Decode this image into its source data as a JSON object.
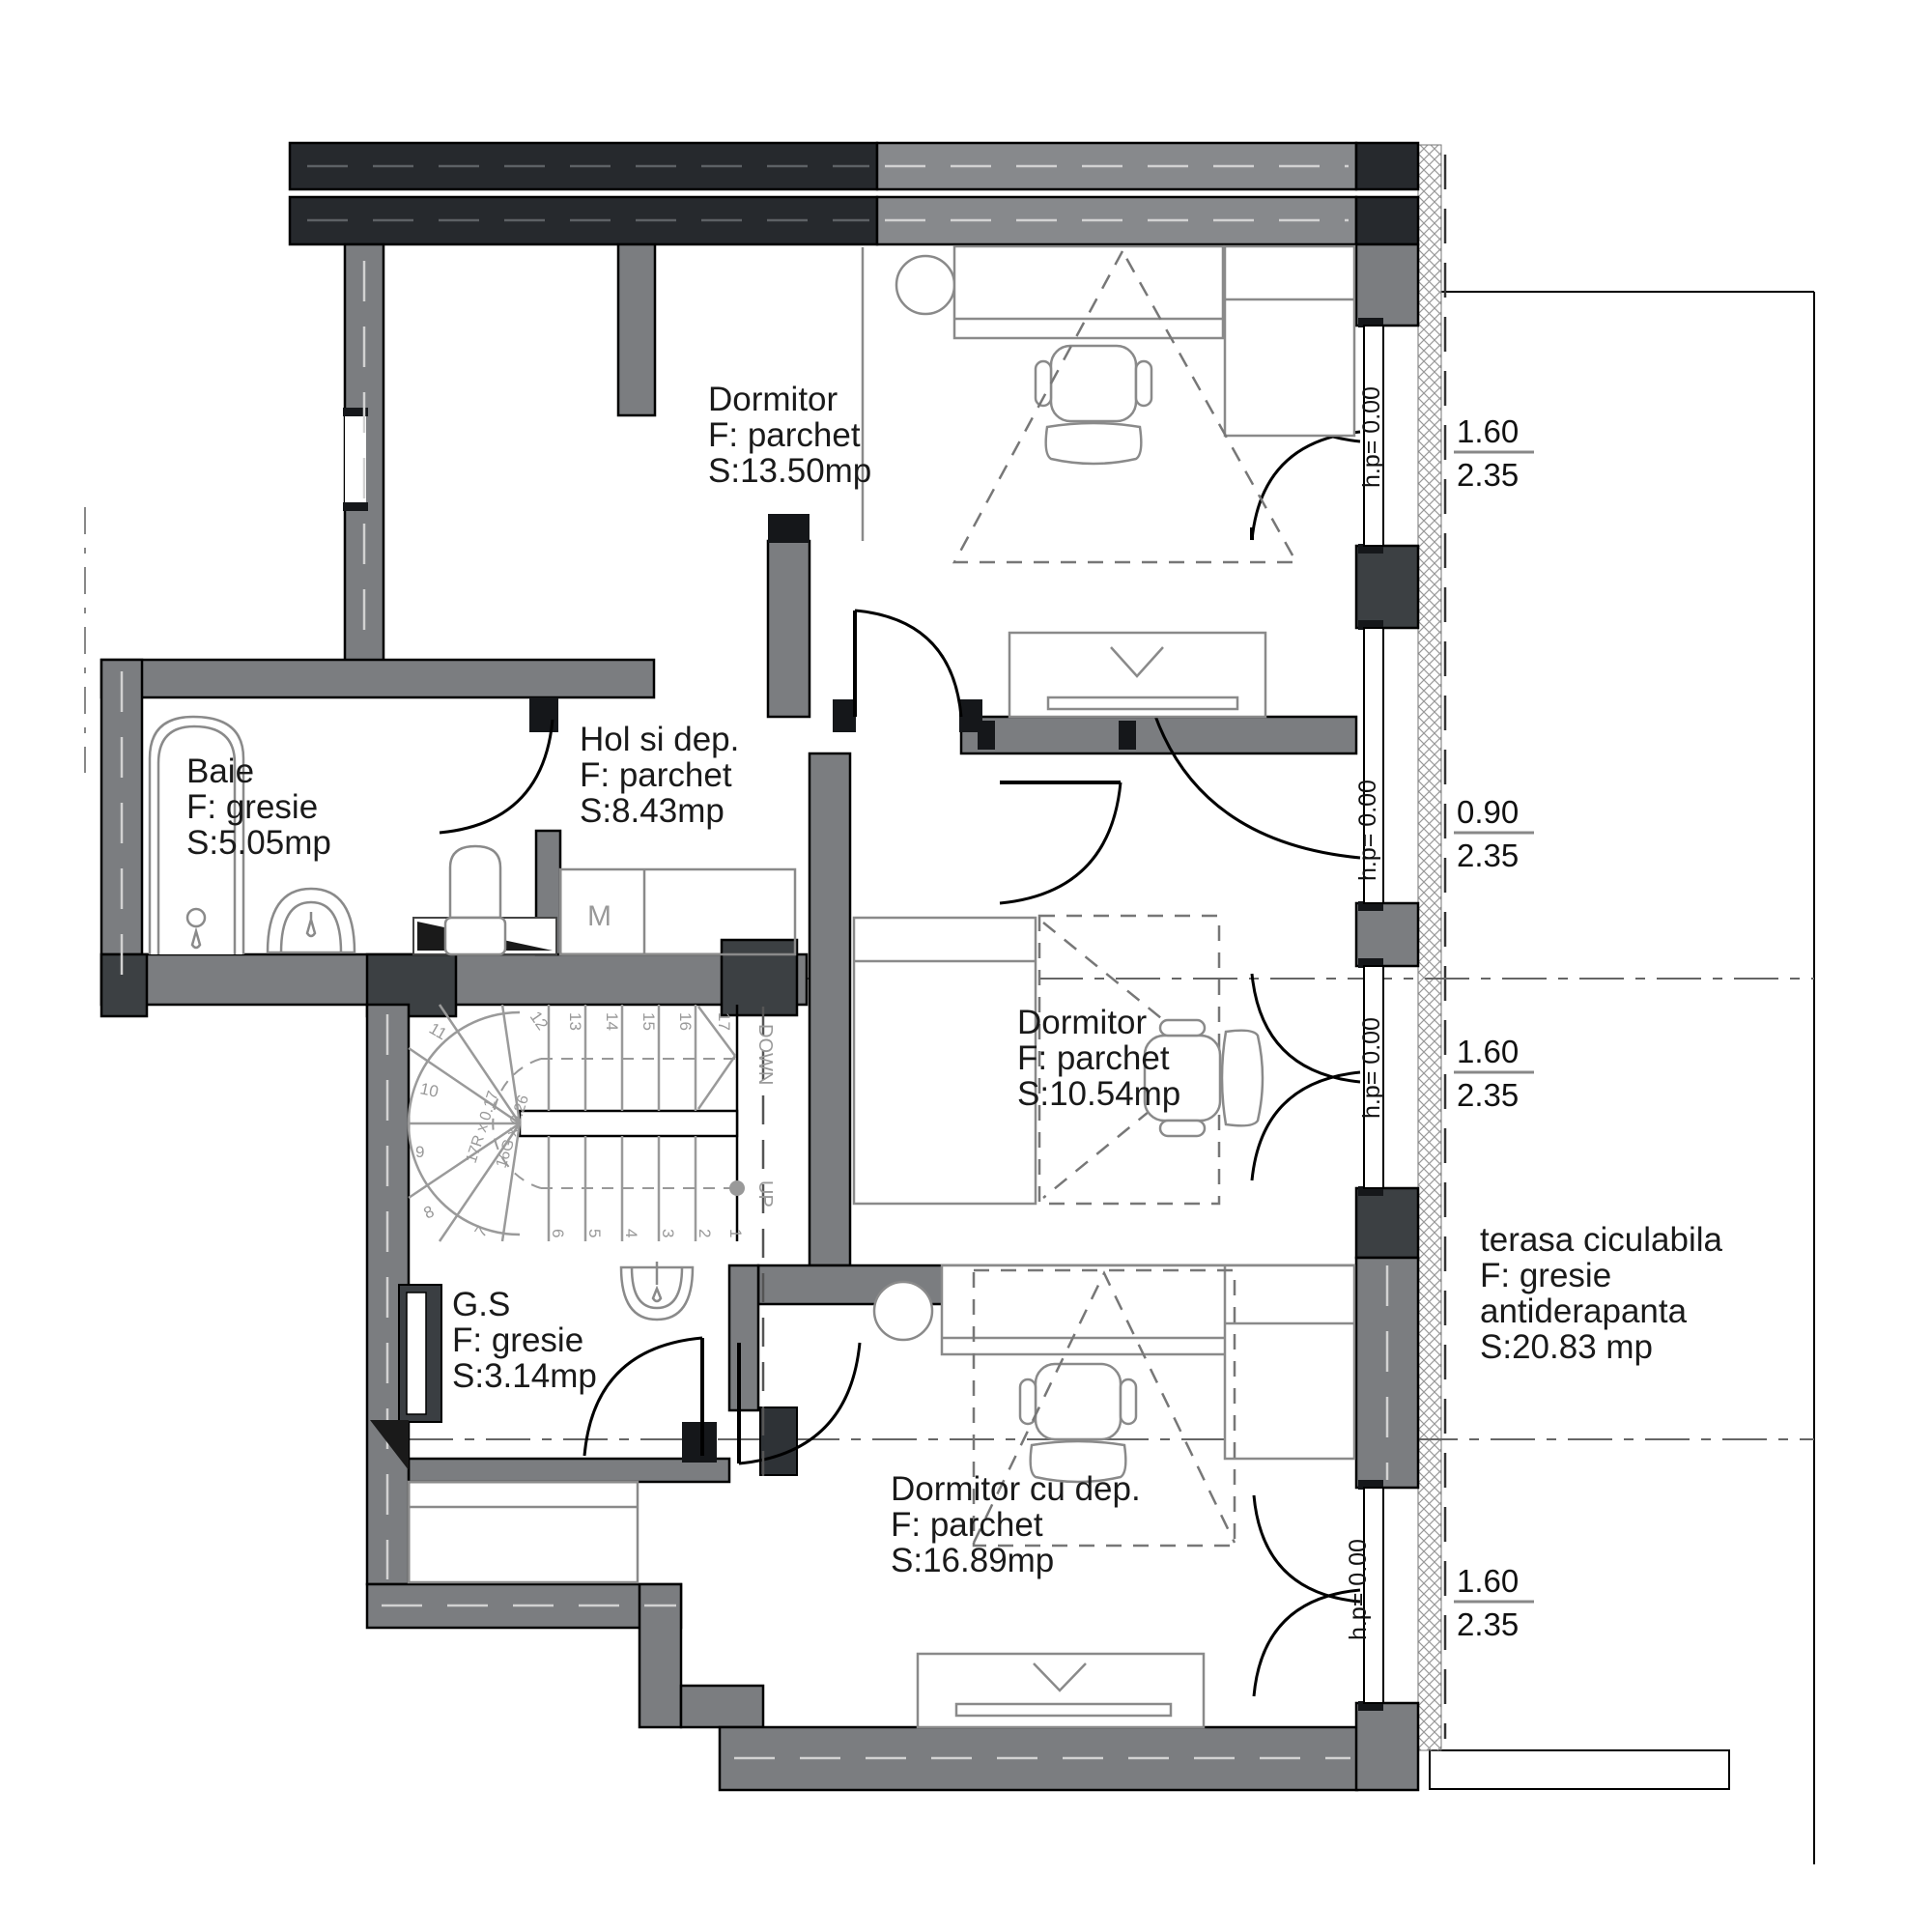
{
  "plan": {
    "rooms": {
      "dormitor_top": {
        "l1": "Dormitor",
        "l2": "F: parchet",
        "l3": "S:13.50mp"
      },
      "baie": {
        "l1": "Baie",
        "l2": "F: gresie",
        "l3": "S:5.05mp"
      },
      "hol": {
        "l1": "Hol si dep.",
        "l2": "F: parchet",
        "l3": "S:8.43mp"
      },
      "dormitor_mid": {
        "l1": "Dormitor",
        "l2": "F: parchet",
        "l3": "S:10.54mp"
      },
      "gs": {
        "l1": "G.S",
        "l2": "F: gresie",
        "l3": "S:3.14mp"
      },
      "dormitor_bottom": {
        "l1": "Dormitor cu dep.",
        "l2": "F: parchet",
        "l3": "S:16.89mp"
      },
      "terasa": {
        "l1": "terasa ciculabila",
        "l2": "F: gresie",
        "l3": "antiderapanta",
        "l4": "S:20.83 mp"
      }
    },
    "windows": {
      "w1": {
        "w": "1.60",
        "h": "2.35",
        "sill": "h.p= 0.00"
      },
      "w2": {
        "w": "0.90",
        "h": "2.35",
        "sill": "h.p= 0.00"
      },
      "w3": {
        "w": "1.60",
        "h": "2.35",
        "sill": "h.p= 0.00"
      },
      "w4": {
        "w": "1.60",
        "h": "2.35",
        "sill": "h.p= 0.00"
      }
    },
    "stairs": {
      "up": "UP",
      "down": "DOWN",
      "note1": "17R x 0.17",
      "note2": "16G x 0.26",
      "s1": "1",
      "s2": "2",
      "s3": "3",
      "s4": "4",
      "s5": "5",
      "s6": "6",
      "s7": "7",
      "s8": "8",
      "s9": "9",
      "s10": "10",
      "s11": "11",
      "s12": "12",
      "s13": "13",
      "s14": "14",
      "s15": "15",
      "s16": "16",
      "s17": "17"
    },
    "labels": {
      "m": "M"
    },
    "colors": {
      "wall_gray": "#7b7d80",
      "wall_dark": "#26292d",
      "accent_black": "#15171a"
    }
  }
}
